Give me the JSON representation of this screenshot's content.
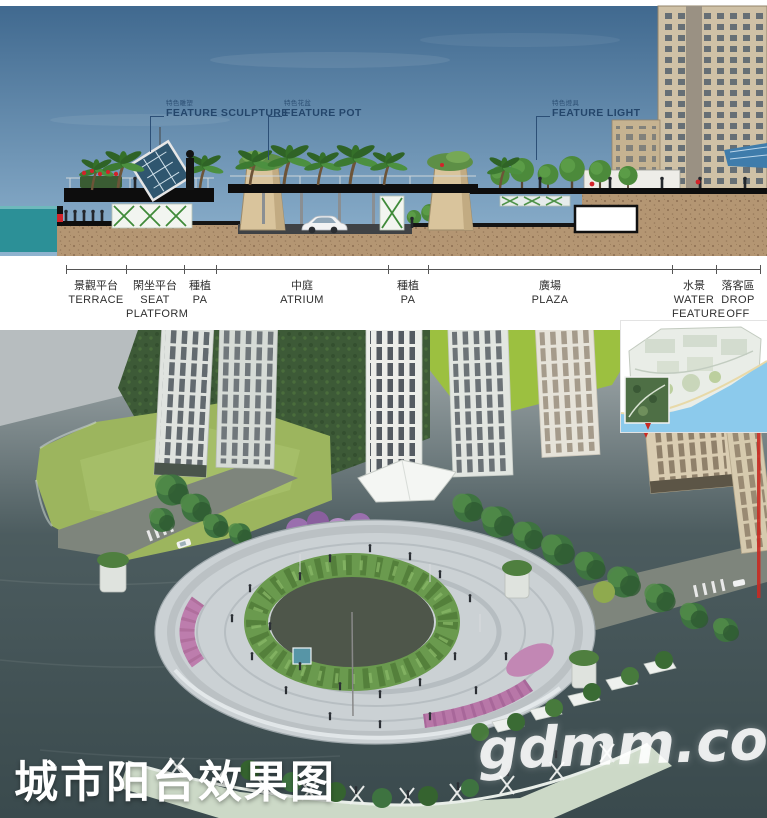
{
  "section": {
    "callouts": [
      {
        "code": "特色雕塑",
        "label": "FEATURE SCULPTURE"
      },
      {
        "code": "特色花盆",
        "label": "FEATURE POT"
      },
      {
        "code": "特色燈具",
        "label": "FEATURE LIGHT"
      }
    ],
    "dim_segments": [
      {
        "zh": "景觀平台",
        "en": "TERRACE"
      },
      {
        "zh": "閑坐平台",
        "en": "SEAT PLATFORM"
      },
      {
        "zh": "種植",
        "en": "PA"
      },
      {
        "zh": "中庭",
        "en": "ATRIUM"
      },
      {
        "zh": "種植",
        "en": "PA"
      },
      {
        "zh": "廣場",
        "en": "PLAZA"
      },
      {
        "zh": "水景",
        "en": "WATER FEATURE"
      },
      {
        "zh": "落客區",
        "en": "DROP OFF"
      }
    ]
  },
  "render": {
    "caption": "城市阳台效果图",
    "watermark": "gdmm.com"
  },
  "colors": {
    "sky-top": "#40698f",
    "sky-bottom": "#8fb3cf",
    "sea": "#2c9097",
    "ground": "#b49673",
    "water-top": "#a8b0b2",
    "water-deep": "#3a4a4d",
    "lawn": "#9cb55e",
    "hill": "#9cc040",
    "forest": "#3d5a37",
    "plaza": "#cbd1d4",
    "shrub-ring": "#6a9a4e",
    "flower-pink": "#bd7dad",
    "flower-red": "#d2232a",
    "accent-red": "#c92a22",
    "map-water": "#8ccaec"
  }
}
